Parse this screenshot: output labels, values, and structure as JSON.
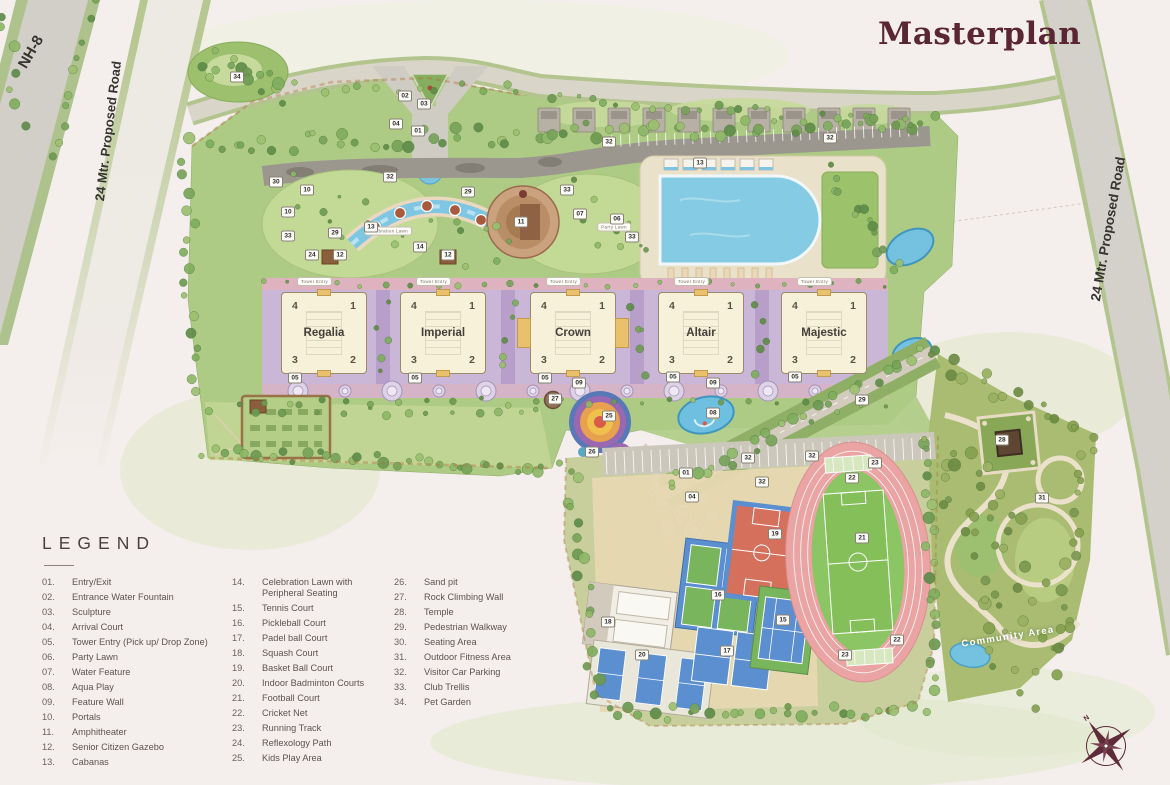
{
  "title": "Masterplan",
  "roads": {
    "nh8": "NH-8",
    "left_proposed": "24 Mtr. Proposed Road",
    "right_proposed": "24 Mtr. Proposed Road"
  },
  "towers": [
    {
      "name": "Regalia",
      "wings": [
        "4",
        "1",
        "3",
        "2"
      ]
    },
    {
      "name": "Imperial",
      "wings": [
        "4",
        "1",
        "3",
        "2"
      ]
    },
    {
      "name": "Crown",
      "wings": [
        "4",
        "1",
        "3",
        "2"
      ]
    },
    {
      "name": "Altair",
      "wings": [
        "4",
        "1",
        "3",
        "2"
      ]
    },
    {
      "name": "Majestic",
      "wings": [
        "4",
        "1",
        "3",
        "2"
      ]
    }
  ],
  "tower_entry_pill": "Tower Entry",
  "lawn_labels": {
    "celebration": "Celebration Lawn",
    "party": "Party Lawn"
  },
  "community_label": "Community Area",
  "compass": {
    "north": "N"
  },
  "legend": {
    "title": "LEGEND",
    "columns": [
      {
        "items": [
          {
            "num": "01.",
            "label": "Entry/Exit"
          },
          {
            "num": "02.",
            "label": "Entrance Water Fountain"
          },
          {
            "num": "03.",
            "label": "Sculpture"
          },
          {
            "num": "04.",
            "label": "Arrival Court"
          },
          {
            "num": "05.",
            "label": "Tower Entry (Pick up/ Drop Zone)"
          },
          {
            "num": "06.",
            "label": "Party Lawn"
          },
          {
            "num": "07.",
            "label": "Water Feature"
          },
          {
            "num": "08.",
            "label": "Aqua Play"
          },
          {
            "num": "09.",
            "label": "Feature Wall"
          },
          {
            "num": "10.",
            "label": "Portals"
          },
          {
            "num": "11.",
            "label": "Amphitheater"
          },
          {
            "num": "12.",
            "label": "Senior Citizen Gazebo"
          },
          {
            "num": "13.",
            "label": "Cabanas"
          }
        ]
      },
      {
        "items": [
          {
            "num": "14.",
            "label": "Celebration Lawn with Peripheral Seating"
          },
          {
            "num": "15.",
            "label": "Tennis Court"
          },
          {
            "num": "16.",
            "label": "Pickleball Court"
          },
          {
            "num": "17.",
            "label": "Padel ball Court"
          },
          {
            "num": "18.",
            "label": "Squash Court"
          },
          {
            "num": "19.",
            "label": "Basket Ball Court"
          },
          {
            "num": "20.",
            "label": "Indoor Badminton Courts"
          },
          {
            "num": "21.",
            "label": "Football Court"
          },
          {
            "num": "22.",
            "label": "Cricket Net"
          },
          {
            "num": "23.",
            "label": "Running Track"
          },
          {
            "num": "24.",
            "label": "Reflexology Path"
          },
          {
            "num": "25.",
            "label": "Kids Play Area"
          }
        ]
      },
      {
        "items": [
          {
            "num": "26.",
            "label": "Sand pit"
          },
          {
            "num": "27.",
            "label": "Rock Climbing Wall"
          },
          {
            "num": "28.",
            "label": "Temple"
          },
          {
            "num": "29.",
            "label": "Pedestrian Walkway"
          },
          {
            "num": "30.",
            "label": "Seating Area"
          },
          {
            "num": "31.",
            "label": "Outdoor Fitness Area"
          },
          {
            "num": "32.",
            "label": "Visitor Car Parking"
          },
          {
            "num": "33.",
            "label": "Club Trellis"
          },
          {
            "num": "34.",
            "label": "Pet Garden"
          }
        ]
      }
    ]
  },
  "map_markers": [
    {
      "n": "34",
      "x": 237,
      "y": 77
    },
    {
      "n": "02",
      "x": 405,
      "y": 96
    },
    {
      "n": "03",
      "x": 424,
      "y": 104
    },
    {
      "n": "04",
      "x": 396,
      "y": 124
    },
    {
      "n": "01",
      "x": 418,
      "y": 131
    },
    {
      "n": "30",
      "x": 276,
      "y": 182
    },
    {
      "n": "10",
      "x": 307,
      "y": 190
    },
    {
      "n": "10",
      "x": 288,
      "y": 212
    },
    {
      "n": "33",
      "x": 567,
      "y": 190
    },
    {
      "n": "29",
      "x": 468,
      "y": 192
    },
    {
      "n": "32",
      "x": 390,
      "y": 177
    },
    {
      "n": "32",
      "x": 609,
      "y": 142
    },
    {
      "n": "32",
      "x": 830,
      "y": 138
    },
    {
      "n": "13",
      "x": 371,
      "y": 227
    },
    {
      "n": "13",
      "x": 700,
      "y": 163
    },
    {
      "n": "07",
      "x": 580,
      "y": 214
    },
    {
      "n": "06",
      "x": 617,
      "y": 219
    },
    {
      "n": "11",
      "x": 521,
      "y": 222
    },
    {
      "n": "33",
      "x": 632,
      "y": 237
    },
    {
      "n": "33",
      "x": 288,
      "y": 236
    },
    {
      "n": "14",
      "x": 420,
      "y": 247
    },
    {
      "n": "24",
      "x": 312,
      "y": 255
    },
    {
      "n": "12",
      "x": 340,
      "y": 255
    },
    {
      "n": "12",
      "x": 448,
      "y": 255
    },
    {
      "n": "29",
      "x": 335,
      "y": 233
    },
    {
      "n": "05",
      "x": 295,
      "y": 378
    },
    {
      "n": "05",
      "x": 415,
      "y": 378
    },
    {
      "n": "05",
      "x": 545,
      "y": 378
    },
    {
      "n": "05",
      "x": 673,
      "y": 377
    },
    {
      "n": "05",
      "x": 795,
      "y": 377
    },
    {
      "n": "09",
      "x": 579,
      "y": 383
    },
    {
      "n": "09",
      "x": 713,
      "y": 383
    },
    {
      "n": "27",
      "x": 555,
      "y": 399
    },
    {
      "n": "25",
      "x": 609,
      "y": 416
    },
    {
      "n": "08",
      "x": 713,
      "y": 413
    },
    {
      "n": "26",
      "x": 592,
      "y": 452
    },
    {
      "n": "29",
      "x": 862,
      "y": 400
    },
    {
      "n": "28",
      "x": 1002,
      "y": 440
    },
    {
      "n": "31",
      "x": 1042,
      "y": 498
    },
    {
      "n": "32",
      "x": 748,
      "y": 458
    },
    {
      "n": "32",
      "x": 812,
      "y": 456
    },
    {
      "n": "32",
      "x": 762,
      "y": 482
    },
    {
      "n": "01",
      "x": 686,
      "y": 473
    },
    {
      "n": "04",
      "x": 692,
      "y": 497
    },
    {
      "n": "19",
      "x": 775,
      "y": 534
    },
    {
      "n": "16",
      "x": 718,
      "y": 595
    },
    {
      "n": "15",
      "x": 783,
      "y": 620
    },
    {
      "n": "17",
      "x": 727,
      "y": 651
    },
    {
      "n": "18",
      "x": 608,
      "y": 622
    },
    {
      "n": "20",
      "x": 642,
      "y": 655
    },
    {
      "n": "23",
      "x": 875,
      "y": 463
    },
    {
      "n": "23",
      "x": 845,
      "y": 655
    },
    {
      "n": "22",
      "x": 852,
      "y": 478
    },
    {
      "n": "22",
      "x": 897,
      "y": 640
    },
    {
      "n": "21",
      "x": 862,
      "y": 538
    }
  ],
  "colors": {
    "accent_maroon": "#5a2535",
    "water": "#7ec4e0",
    "track_pink": "#eaa4a4",
    "field_green": "#8cc563",
    "paving_lavender": "#cab6d6",
    "tower_cream": "#f8f1da"
  }
}
